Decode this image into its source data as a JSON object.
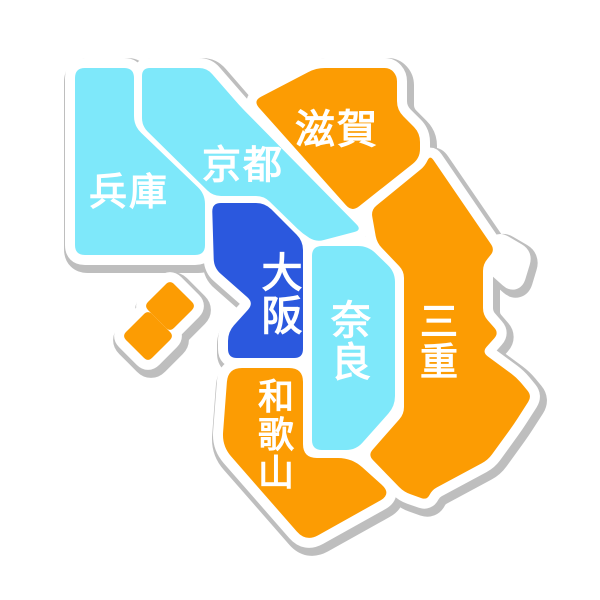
{
  "map": {
    "background": "#ffffff",
    "colors": {
      "cyan": "#7EE8FA",
      "orange": "#FC9C03",
      "blue": "#2B58DE",
      "white": "#FFFFFF",
      "gray": "#BEBEBE",
      "label_text": "#FFFFFF"
    },
    "outline": {
      "white_width": 20,
      "gray_width": 28,
      "offset_x": 3,
      "offset_y": 4,
      "corner_radius": 9
    },
    "regions": [
      {
        "id": "hyogo",
        "label": "兵庫",
        "color": "cyan",
        "label_layout": "horizontal",
        "label_x": 129,
        "label_y": 193,
        "font_size": 38,
        "corner_radius": 10,
        "points": [
          [
            75,
            68
          ],
          [
            134,
            68
          ],
          [
            134,
            126
          ],
          [
            205,
            194
          ],
          [
            205,
            255
          ],
          [
            75,
            255
          ]
        ]
      },
      {
        "id": "kyoto",
        "label": "京都",
        "color": "cyan",
        "label_layout": "horizontal",
        "label_x": 243,
        "label_y": 166,
        "font_size": 39,
        "corner_radius": 8,
        "points": [
          [
            142,
            68
          ],
          [
            207,
            68
          ],
          [
            239,
            105
          ],
          [
            362,
            230
          ],
          [
            316,
            242
          ],
          [
            303,
            234
          ],
          [
            264,
            196
          ],
          [
            213,
            196
          ],
          [
            142,
            126
          ]
        ]
      },
      {
        "id": "shiga",
        "label": "滋賀",
        "color": "orange",
        "label_layout": "horizontal",
        "label_x": 337,
        "label_y": 130,
        "font_size": 40,
        "corner_radius": 9,
        "points": [
          [
            253,
            101
          ],
          [
            316,
            68
          ],
          [
            390,
            68
          ],
          [
            397,
            76
          ],
          [
            397,
            110
          ],
          [
            420,
            133
          ],
          [
            420,
            158
          ],
          [
            352,
            212
          ]
        ]
      },
      {
        "id": "osaka",
        "label": "大阪",
        "color": "blue",
        "label_layout": "vertical",
        "label_x": 282,
        "label_y": 252,
        "font_size": 41,
        "corner_radius": 9,
        "points": [
          [
            212,
            203
          ],
          [
            265,
            203
          ],
          [
            303,
            241
          ],
          [
            303,
            358
          ],
          [
            228,
            358
          ],
          [
            228,
            332
          ],
          [
            254,
            303
          ],
          [
            214,
            268
          ]
        ]
      },
      {
        "id": "nara",
        "label": "奈良",
        "color": "cyan",
        "label_layout": "vertical",
        "label_x": 351,
        "label_y": 300,
        "font_size": 40,
        "corner_radius": 10,
        "points": [
          [
            312,
            246
          ],
          [
            368,
            246
          ],
          [
            395,
            272
          ],
          [
            395,
            406
          ],
          [
            356,
            450
          ],
          [
            312,
            450
          ]
        ]
      },
      {
        "id": "mie",
        "label": "三重",
        "color": "orange",
        "label_layout": "vertical",
        "label_x": 439,
        "label_y": 303,
        "font_size": 38,
        "corner_radius": 7,
        "points": [
          [
            430,
            155
          ],
          [
            495,
            250
          ],
          [
            483,
            264
          ],
          [
            483,
            315
          ],
          [
            499,
            333
          ],
          [
            482,
            352
          ],
          [
            517,
            378
          ],
          [
            532,
            396
          ],
          [
            514,
            424
          ],
          [
            488,
            460
          ],
          [
            432,
            490
          ],
          [
            427,
            500
          ],
          [
            404,
            492
          ],
          [
            368,
            455
          ],
          [
            404,
            414
          ],
          [
            404,
            271
          ],
          [
            377,
            243
          ],
          [
            371,
            210
          ],
          [
            425,
            166
          ]
        ]
      },
      {
        "id": "wakayama",
        "label": "和歌山",
        "color": "orange",
        "label_layout": "vertical",
        "label_x": 276,
        "label_y": 378,
        "font_size": 36,
        "corner_radius": 14,
        "points": [
          [
            228,
            368
          ],
          [
            303,
            368
          ],
          [
            303,
            458
          ],
          [
            352,
            458
          ],
          [
            392,
            494
          ],
          [
            306,
            542
          ],
          [
            222,
            446
          ]
        ]
      },
      {
        "id": "awaji-island-north",
        "label": null,
        "color": "orange",
        "corner_radius": 6,
        "points": [
          [
            170,
            280
          ],
          [
            196,
            306
          ],
          [
            170,
            332
          ],
          [
            144,
            306
          ]
        ]
      },
      {
        "id": "awaji-island-south",
        "label": null,
        "color": "orange",
        "corner_radius": 6,
        "points": [
          [
            148,
            310
          ],
          [
            174,
            336
          ],
          [
            148,
            362
          ],
          [
            122,
            336
          ]
        ]
      },
      {
        "id": "coast-knob",
        "label": null,
        "color": null,
        "corner_radius": 6,
        "points": [
          [
            498,
            242
          ],
          [
            522,
            256
          ],
          [
            514,
            282
          ],
          [
            496,
            266
          ]
        ]
      }
    ]
  }
}
